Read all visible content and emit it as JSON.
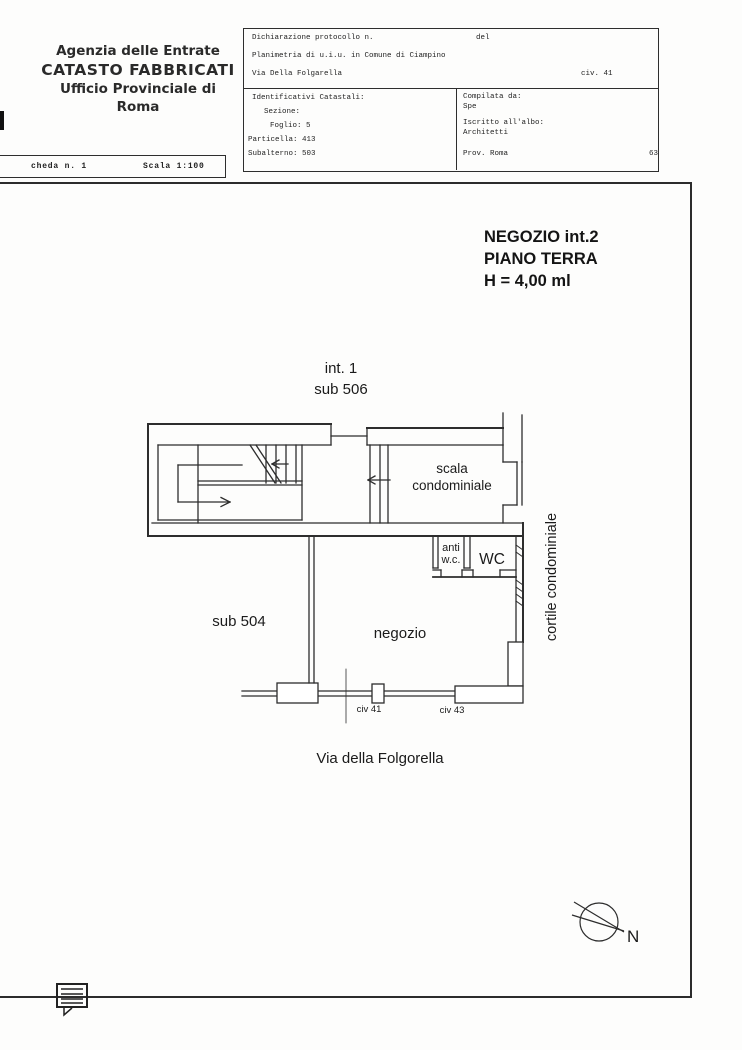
{
  "agency": {
    "line1": "Agenzia delle Entrate",
    "line2": "CATASTO FABBRICATI",
    "line3": "Ufficio Provinciale di",
    "line4": "Roma"
  },
  "scheda": {
    "number": "cheda n. 1",
    "scale": "Scala 1:100"
  },
  "protocol": {
    "dichiarazione": "Dichiarazione protocollo n.",
    "del": "del",
    "planimetria": "Planimetria di u.i.u. in Comune di Ciampino",
    "via": "Via Della Folgarella",
    "civ": "civ. 41"
  },
  "identificativi": {
    "title": "Identificativi Catastali:",
    "sezione": "Sezione:",
    "foglio": "Foglio: 5",
    "particella": "Particella: 413",
    "subalterno": "Subalterno: 503"
  },
  "compilata": {
    "title": "Compilata da:",
    "name": "Spe",
    "albo": "Iscritto all'albo:",
    "albo_value": "Architetti",
    "prov": "Prov. Roma",
    "num": "63"
  },
  "unit": {
    "line1": "NEGOZIO int.2",
    "line2": "PIANO TERRA",
    "line3": "H = 4,00 ml"
  },
  "plan": {
    "int1": "int. 1",
    "sub506": "sub 506",
    "scala_line1": "scala",
    "scala_line2": "condominiale",
    "anti_line1": "anti",
    "anti_line2": "w.c.",
    "wc": "WC",
    "sub504": "sub 504",
    "negozio": "negozio",
    "civ41": "civ 41",
    "civ43": "civ 43",
    "cortile": "cortile condominiale",
    "street": "Via della Folgorella"
  },
  "compass": {
    "north": "N"
  },
  "colors": {
    "ink": "#2d2d2d",
    "paper": "#fdfdfc"
  }
}
